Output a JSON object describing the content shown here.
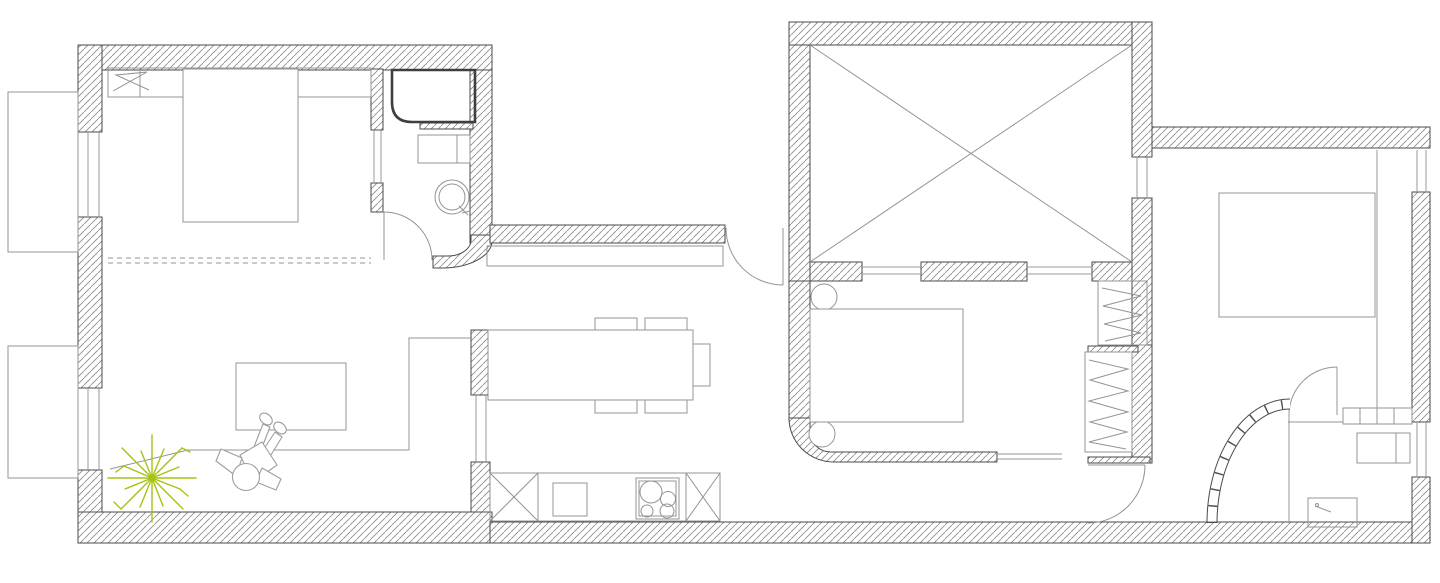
{
  "title": "",
  "colors": {
    "wall_line": "#4a4a4a",
    "hatch_line": "#8a8a8a",
    "furniture_line": "#949494",
    "window_line": "#9a9a9a",
    "dark_line": "#3f3f3f",
    "plant_color": "#a6c213",
    "person_line": "#9e9e9e",
    "background": "#ffffff"
  },
  "plan": {
    "rooms": [
      "bedroom-left",
      "bathroom-left",
      "living-room",
      "kitchen-dining",
      "corridor",
      "storage-room-x",
      "bedroom-middle",
      "hallway",
      "bedroom-right",
      "bathroom-right"
    ],
    "furniture": [
      "double-bed-left",
      "headboard-shelf",
      "radiator-zigzag",
      "shower-cabin",
      "washing-machine-left",
      "round-washbasin",
      "coffee-table",
      "lounge-person",
      "potted-plant",
      "dining-table",
      "dining-chairs",
      "kitchen-counter",
      "kitchen-sink",
      "cooktop-4-burners",
      "base-cabinet-x",
      "corridor-bench",
      "double-bed-middle",
      "round-nightstands",
      "wardrobe-upper",
      "wardrobe-lower",
      "sliding-door",
      "double-bed-right",
      "tiled-counter",
      "washing-machine-right",
      "shower-tray",
      "glass-block-wall",
      "balcony-top",
      "balcony-bottom"
    ]
  }
}
